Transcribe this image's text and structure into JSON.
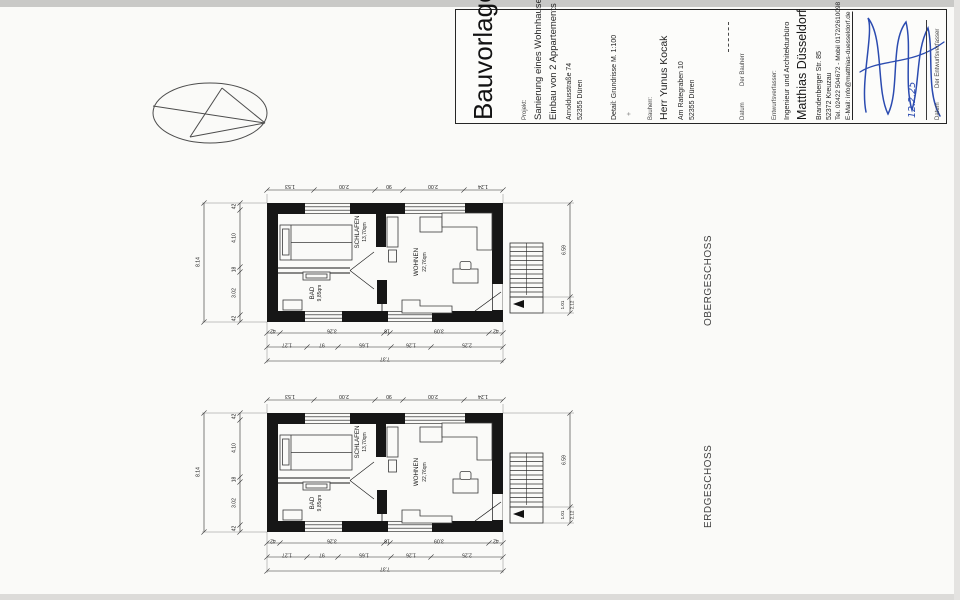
{
  "titleblock": {
    "doc_title": "Bauvorlagen",
    "project_label": "Projekt:",
    "project_line1": "Sanierung eines Wohnhauses",
    "project_line2": "Einbau von 2 Appartements",
    "project_street": "Arnoldusstraße 74",
    "project_city": "52355 Düren",
    "detail": "Detail: Grundrisse M. 1:100",
    "plus_mark": "+",
    "client_label": "Bauherr:",
    "client_name": "Herr Yunus Kocak",
    "client_street": "Am Rategraben 10",
    "client_city": "52355 Düren",
    "sign_datum": "Datum",
    "client_sign_who": "Der Bauherr",
    "designer_label": "Entwurfsverfasser:",
    "designer_office": "Ingenieur und Architekturbüro",
    "designer_name": "Matthias Düsseldorf",
    "designer_street": "Brandenberger Str. 85",
    "designer_city": "52372 Kreuzau",
    "designer_tel": "Tel. 02422 504672 - Mobil 0172/2610098",
    "designer_email": "E-Mail: info@matthias-duesseldorf.de",
    "designer_sign_who": "Der Entwurfsverfasser",
    "signature_date": "12.2.25",
    "signature_color": "#2b4bb0"
  },
  "plans": [
    {
      "name": "OBERGESCHOSS",
      "rooms": {
        "schlafen": {
          "name": "SCHLAFEN",
          "area": "13,70qm"
        },
        "wohnen": {
          "name": "WOHNEN",
          "area": "22,76qm"
        },
        "bad": {
          "name": "BAD",
          "area": "9,85qm"
        }
      }
    },
    {
      "name": "ERDGESCHOSS",
      "rooms": {
        "schlafen": {
          "name": "SCHLAFEN",
          "area": "13,70qm"
        },
        "wohnen": {
          "name": "WOHNEN",
          "area": "22,76qm"
        },
        "bad": {
          "name": "BAD",
          "area": "9,85qm"
        }
      }
    }
  ],
  "dims": {
    "top": [
      "1.53",
      "2.00",
      "90",
      "2.00",
      "1.24"
    ],
    "bottom_inner": [
      "42",
      "3.26",
      "18",
      "3.09",
      "42"
    ],
    "bottom_mid": [
      "1.27",
      "97",
      "1.65",
      "1.26",
      "2.25"
    ],
    "bottom_total": "7.37",
    "left": [
      "42",
      "4.10",
      "18",
      "3.02",
      "42"
    ],
    "left_total": "8.14",
    "right": [
      "6.59",
      "1.01",
      "2.12"
    ]
  }
}
